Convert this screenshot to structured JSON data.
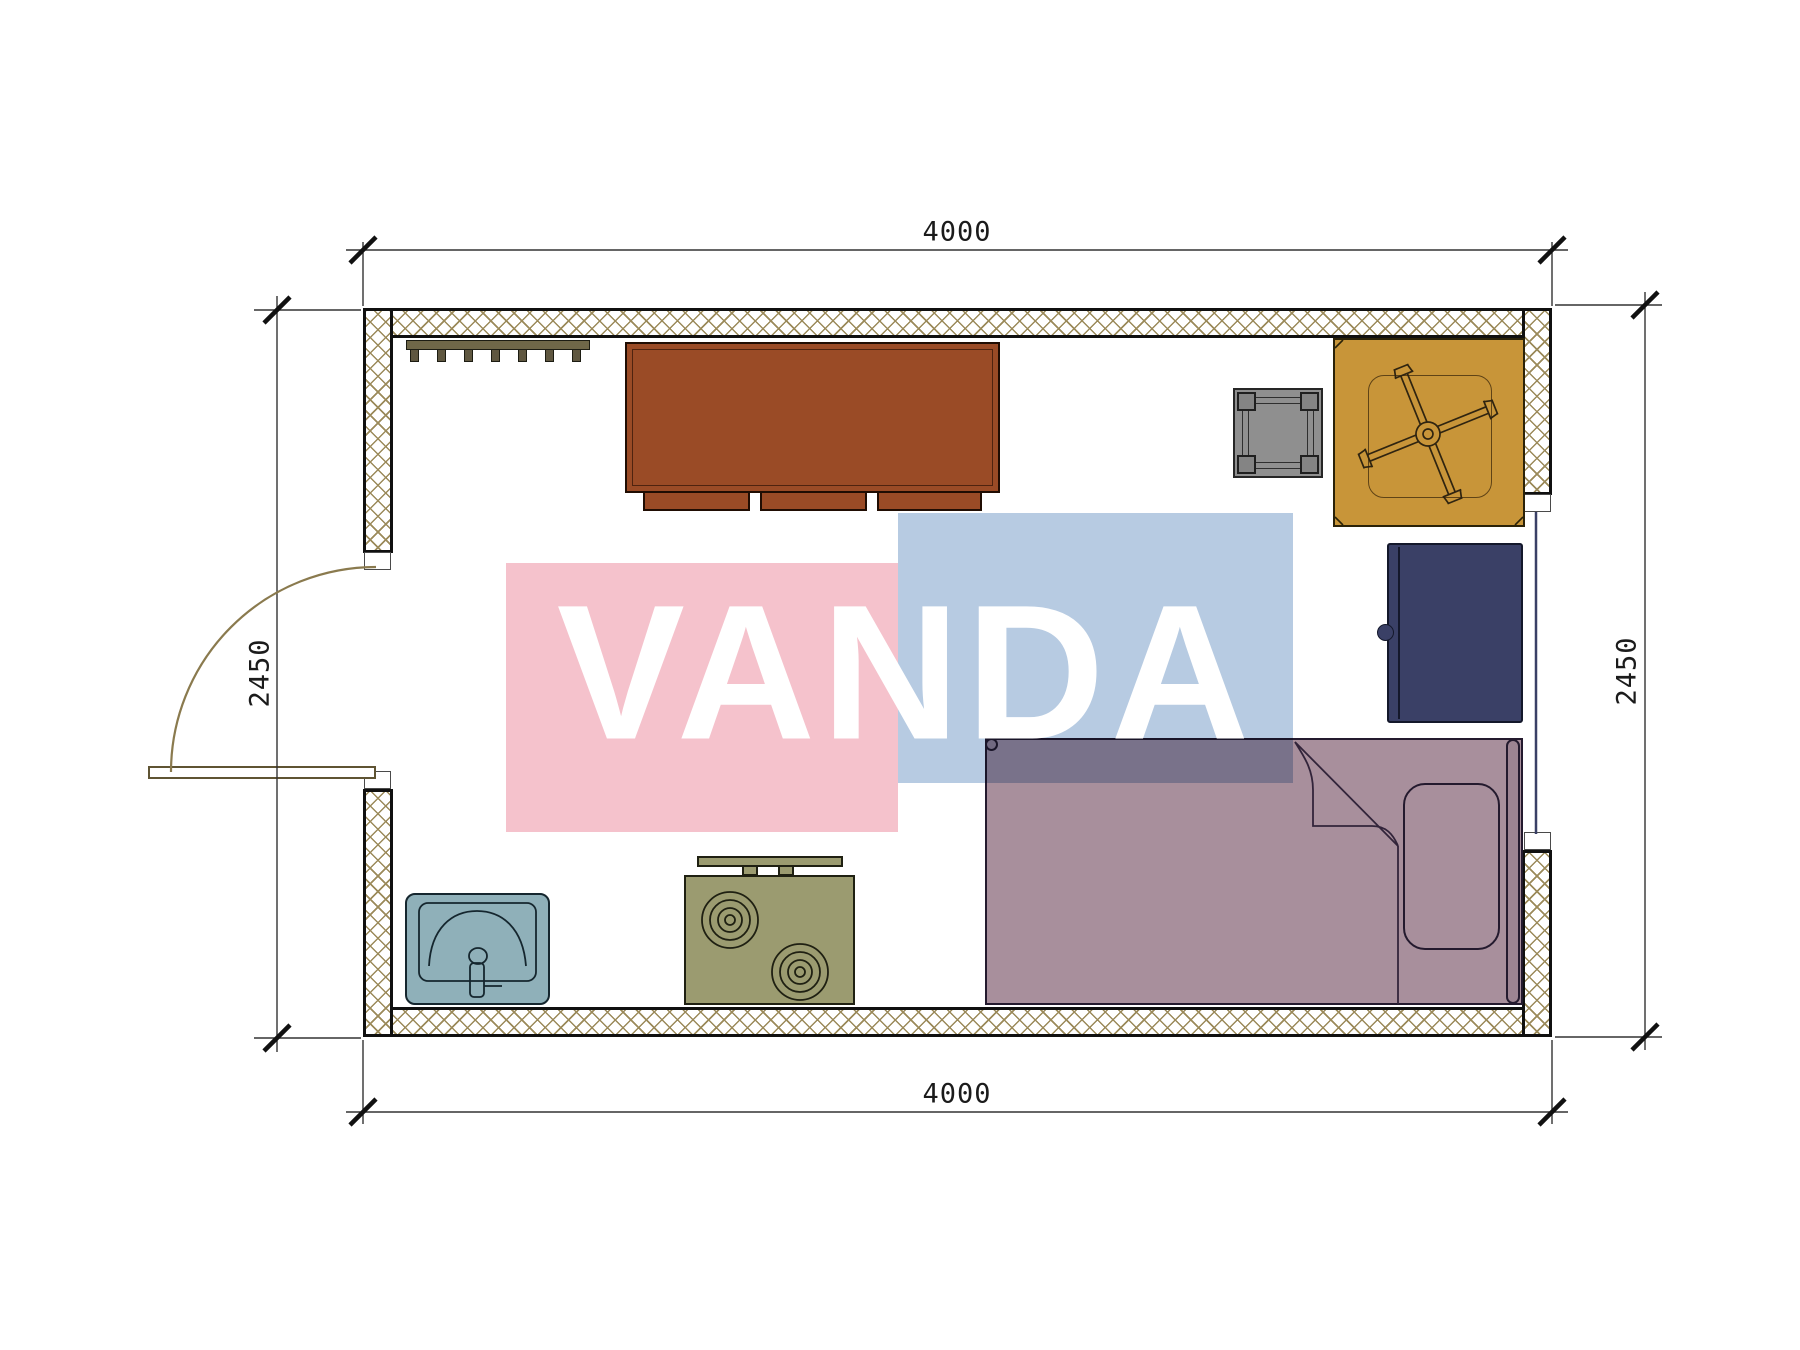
{
  "plan": {
    "type": "floor-plan",
    "watermark_text": "VANDA",
    "dimensions": {
      "top": "4000",
      "bottom": "4000",
      "left": "2450",
      "right": "2450"
    },
    "furniture_icons": [
      "coat-rack-icon",
      "dresser-icon",
      "stool-icon",
      "table-with-chair-base-icon",
      "navy-cabinet-icon",
      "bed-with-pillow-icon",
      "sink-icon",
      "stove-icon",
      "door-swing-icon",
      "window-icon"
    ]
  },
  "colors": {
    "wall_hatch": "#9b8a5a",
    "wall_line": "#101010",
    "dim_line": "#333333",
    "cabinet_brown": "#9a4b26",
    "table_tan": "#c89539",
    "stool_gray": "#8f8f8f",
    "cabinet_navy": "#3a4066",
    "bed_mauve": "#a88f9c",
    "sink_blue": "#8fb0b9",
    "stove_olive": "#9b9b70",
    "rack_olive": "#6f6748",
    "door_line": "#8a7a4e",
    "detail_line": "#2f2410",
    "watermark_pink": "#f5c2cc",
    "watermark_blue": "#b7cbe2"
  }
}
